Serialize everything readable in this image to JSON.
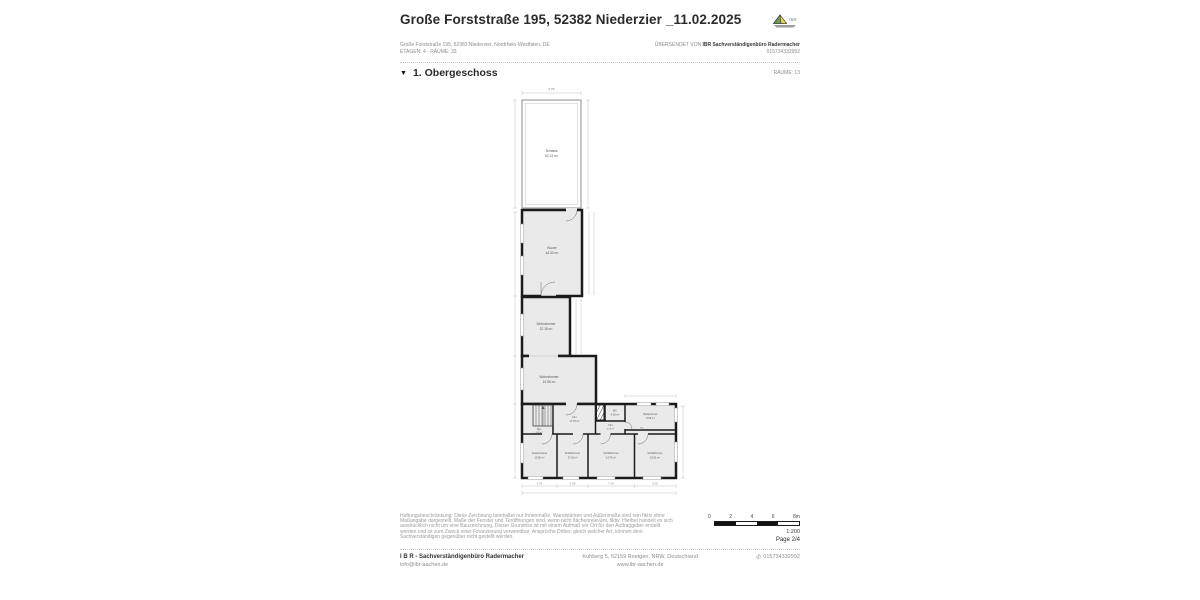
{
  "header": {
    "title": "Große Forststraße 195, 52382 Niederzier _11.02.2025",
    "logo_text": "IBR"
  },
  "property": {
    "address_line": "Große Forststraße 195, 52382 Niederzier, Nordrhein-Westfalen, DE",
    "meta_line": "ETAGEN: 4 · RÄUME: 33",
    "sent_by_prefix": "ÜBERSENDET VON ",
    "sent_by_name": "IBR Sachverständigenbüro Radermacher",
    "sent_by_phone": "015734332992"
  },
  "section": {
    "collapse_icon": "▼",
    "floor_label": "1. Obergeschoss",
    "rooms_label": "RÄUME: 13"
  },
  "floorplan": {
    "rooms": [
      {
        "name": "Terrasse",
        "area": "62.13 m²"
      },
      {
        "name": "Küche",
        "area": "44.33 m²"
      },
      {
        "name": "Wohnzimmer",
        "area": "22.18 m²"
      },
      {
        "name": "Wohnzimmer",
        "area": "19.59 m²"
      },
      {
        "name": "Flur",
        "area": "4.85 m²"
      },
      {
        "name": "Flur",
        "area": "17.76 m²"
      },
      {
        "name": "WC",
        "area": "4.05 m²"
      },
      {
        "name": "Badezimmer",
        "area": "8.63 m²"
      },
      {
        "name": "Flur",
        "area": "4.74 m²"
      },
      {
        "name": "Flur",
        "area": "0.74 m²"
      },
      {
        "name": "Kinderzimmer",
        "area": "15.80 m²"
      },
      {
        "name": "Schlafzimmer",
        "area": "17.33 m²"
      },
      {
        "name": "Schlafzimmer",
        "area": "14.76 m²"
      },
      {
        "name": "Schlafzimmer",
        "area": "15.63 m²"
      }
    ],
    "dims": {
      "top": "5.58",
      "bottom": [
        "3.57",
        "3.69",
        "7.20",
        "3.02"
      ]
    }
  },
  "disclaimer": {
    "lines": [
      "Haftungsbeschränkung: Diese Zeichnung beinhaltet nur Innenmaße. Wandstärken und Außenmaße sind rein fiktiv ohne",
      "Maßangabe dargestellt. Maße der Fenster und Türöffnungen sind, wenn nicht flächenrelevant, fiktiv. Hierbei handelt es sich",
      "ausdrücklich nicht um eine Bauzeichnung. Dieser Grundriss ist mit einem Aufmaß vor Ort für den Auftraggeber erstellt",
      "worden und ist zum Zweck einer Finanzierung verwendbar. Ansprüche Dritter, gleich welcher Art, können dem",
      "Sachverständigen gegenüber nicht gestellt werden."
    ]
  },
  "scale": {
    "ticks": [
      "0",
      "2",
      "4",
      "6",
      "8m"
    ],
    "ratio": "1:200",
    "page": "Page 2/4"
  },
  "footer": {
    "company": "I B R - Sachverständigenbüro Radermacher",
    "email": "info@ibr-aachen.de",
    "address": "Kuhberg 5, 52159 Roetgen, NRW, Deutschland",
    "website": "www.ibr-aachen.de",
    "phone_icon": "✆",
    "phone": "015734332992"
  },
  "colors": {
    "room_fill": "#eaeaea",
    "wall": "#1b1b1b",
    "text_gray": "#8d8d8d",
    "logo_green": "#6f9c55",
    "logo_yellow": "#e6d34f"
  }
}
